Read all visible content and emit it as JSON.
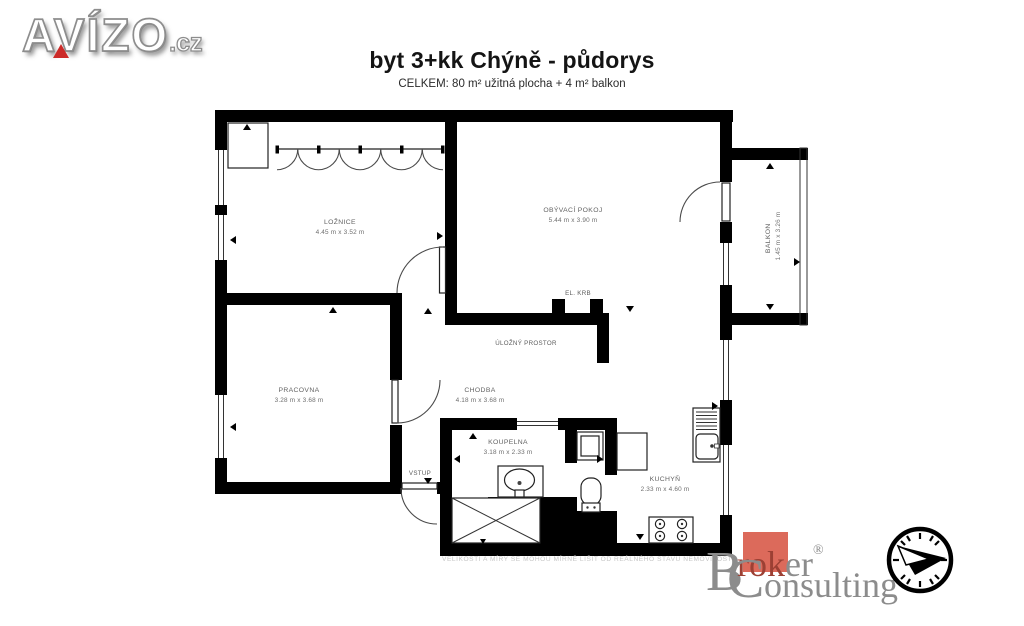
{
  "branding": {
    "avizo": {
      "name": "AVÍZO",
      "tld": ".cz"
    },
    "broker": {
      "b": "B",
      "rok": "rok",
      "er": "er",
      "reg": "®",
      "c": "C",
      "onsulting": "onsulting"
    }
  },
  "header": {
    "title": "byt 3+kk Chýně - půdorys",
    "subtitle": "CELKEM: 80 m² užitná plocha + 4 m² balkon"
  },
  "floorplan": {
    "rooms": {
      "loznice": {
        "name": "LOŽNICE",
        "dims": "4.45 m x 3.52 m"
      },
      "obyvaci": {
        "name": "OBÝVACÍ POKOJ",
        "dims": "5.44 m x 3.90 m"
      },
      "balkon": {
        "name": "BALKON",
        "dims": "1.45 m x 3.26 m"
      },
      "pracovna": {
        "name": "PRACOVNA",
        "dims": "3.28 m x 3.68 m"
      },
      "chodba": {
        "name": "CHODBA",
        "dims": "4.18 m x 3.68 m"
      },
      "koupelna": {
        "name": "KOUPELNA",
        "dims": "3.18 m x 2.33 m"
      },
      "kuchyn": {
        "name": "KUCHYŇ",
        "dims": "2.33 m x 4.60 m"
      }
    },
    "features": {
      "krb": "EL. KRB",
      "ulozny": "ÚLOŽNÝ PROSTOR",
      "vstup": "VSTUP"
    },
    "disclaimer": "VELIKOSTI A MÍRY SE MOHOU MÍRNĚ LIŠIT OD REÁLNÉHO STAVU NEMOVITOSTI."
  },
  "colors": {
    "wall": "#000000",
    "label_gray": "#636363",
    "avizo_red": "#cc2a28",
    "broker_gray": "#8c8c8c",
    "broker_square_red": "#dc6a5b",
    "disclaimer_gray": "#c6c6c6"
  }
}
